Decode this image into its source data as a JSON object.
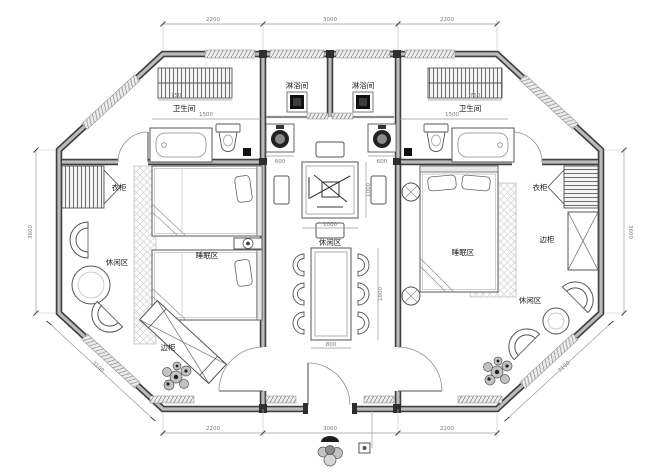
{
  "colors": {
    "paper": "#ffffff",
    "wall_dark": "#3f3f3f",
    "wall_fill": "#bcbcbc",
    "line": "#555555",
    "light_line": "#bbbbbb",
    "hatch": "#cccccc",
    "dim_line": "#9a9a9a",
    "dim_text": "#7a7a7a",
    "label_text": "#1a1a1a",
    "drain": "#111111"
  },
  "labels": {
    "shower_left": "淋浴间",
    "shower_right": "淋浴间",
    "bathroom_left": "卫生间",
    "bathroom_right": "卫生间",
    "wardrobe_left": "衣柜",
    "wardrobe_right": "衣柜",
    "sleep_left": "睡眠区",
    "sleep_right": "睡眠区",
    "leisure_left": "休闲区",
    "leisure_center": "休闲区",
    "leisure_right": "休闲区",
    "cabinet_left": "边柜",
    "cabinet_right": "边柜"
  },
  "dimensions": {
    "top": [
      "2200",
      "3000",
      "2200"
    ],
    "bottom": [
      "2200",
      "3000",
      "2200"
    ],
    "left_wall": "3600",
    "right_wall": "3600",
    "diag_bottom_left": "3100",
    "diag_bottom_right": "3100",
    "interior": {
      "shelf_left": "750",
      "shelf_right": "750",
      "bath_left_width": "1500",
      "bath_right_width": "1500",
      "basin_left": "600",
      "basin_right": "600",
      "game_table_width": "1000",
      "game_table_depth": "1000",
      "dining_table_width": "800",
      "dining_table_length": "1800"
    }
  },
  "icons": {
    "floor_drain": "black-square-drain",
    "washbasin": "dark-round-basin",
    "toilet": "toilet",
    "bathtub": "bathtub",
    "towel_shelf": "striped-shelf",
    "wardrobe": "striped-wardrobe-with-bifold",
    "twin_bed": "twin-bed",
    "double_bed": "double-bed",
    "nightstand": "nightstand-with-lamp",
    "side_table": "round-cross-table",
    "lounge_chair": "half-round-chair",
    "coffee_table": "round-table",
    "game_table": "square-game-table",
    "stool": "bench-stool",
    "dining_table": "rect-dining-table",
    "dining_chair": "ring-chair",
    "side_cabinet": "crossed-cabinet",
    "rug": "crosshatch-rug",
    "plant": "shrub-plant",
    "door": "swing-door-arc",
    "window": "hatched-sill",
    "entry_ornament": "statuette"
  }
}
